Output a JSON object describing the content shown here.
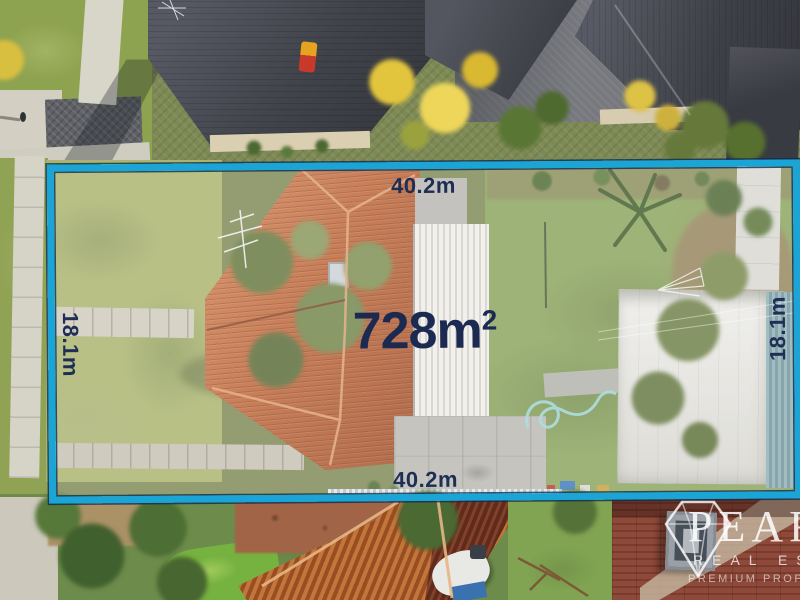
{
  "overlay": {
    "area": {
      "value": "728m",
      "superscript": "2"
    },
    "dimensions": {
      "top": "40.2m",
      "bottom": "40.2m",
      "left": "18.1m",
      "right": "18.1m"
    },
    "boundary_color": "#1ba4d6",
    "label_color": "#1e2e54"
  },
  "watermark": {
    "brand": "PEARL",
    "subtitle": "REAL ESTATE",
    "tagline": "PREMIUM PROPERTY PEOPLE",
    "icon": "diamond-icon"
  },
  "scene": {
    "description": "Aerial drone photo of a 728 sqm suburban property outlined in cyan, house with terracotta tiled roof, front and rear lawns, white patio and garage roofs, neighbouring dark-roofed townhouses above and orange corrugated roof below"
  }
}
